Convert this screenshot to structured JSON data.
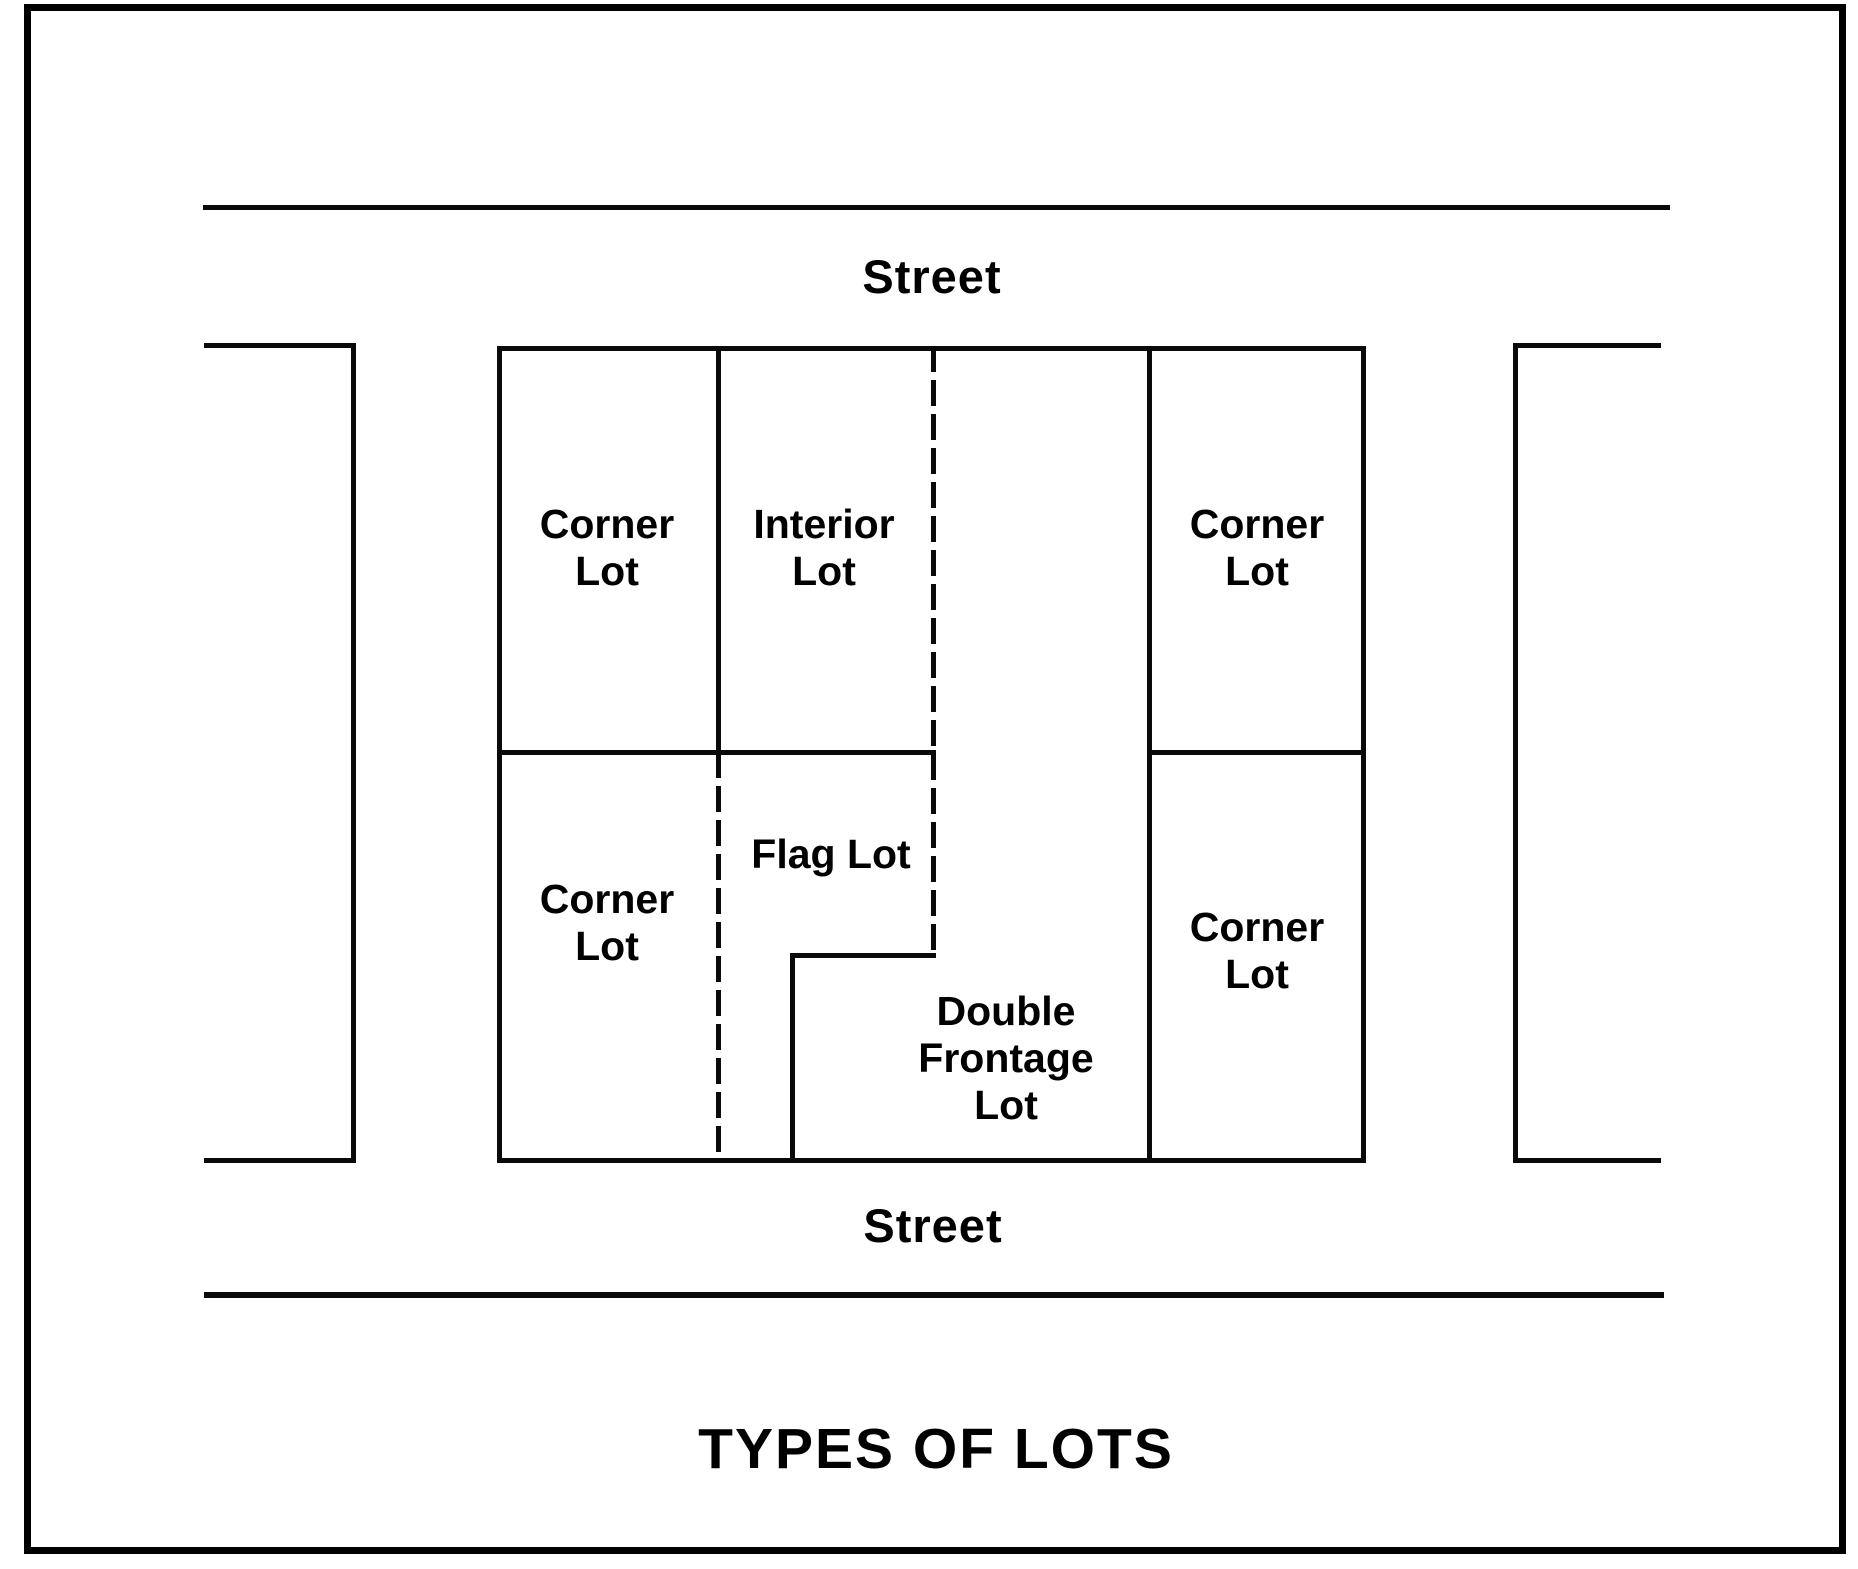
{
  "page": {
    "background_color": "#ffffff",
    "ink_color": "#0a0a0a"
  },
  "diagram": {
    "title": "TYPES OF LOTS",
    "streets": {
      "top_label": "Street",
      "bottom_label": "Street"
    },
    "lots": {
      "corner_top_left": "Corner\nLot",
      "interior": "Interior\nLot",
      "corner_top_right": "Corner\nLot",
      "corner_bottom_left": "Corner\nLot",
      "flag": "Flag Lot",
      "double_frontage": "Double\nFrontage\nLot",
      "corner_bottom_right": "Corner\nLot"
    }
  }
}
